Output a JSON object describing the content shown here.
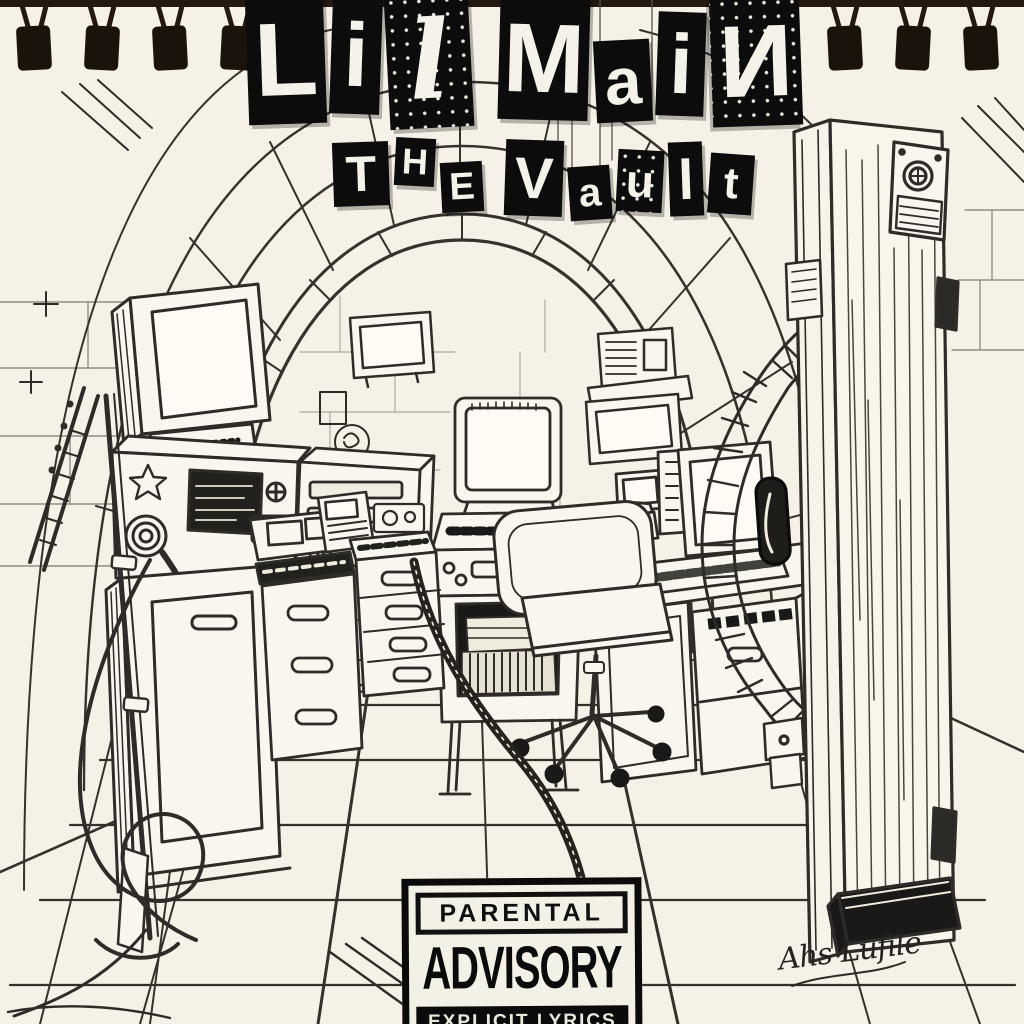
{
  "cover": {
    "title": {
      "text": "LiL MaiN",
      "words": [
        {
          "letters": [
            "L",
            "i",
            "L"
          ]
        },
        {
          "letters": [
            "M",
            "a",
            "i",
            "N"
          ]
        }
      ]
    },
    "subtitle": {
      "text": "The Vault",
      "words": [
        {
          "letters": [
            "T",
            "H",
            "E"
          ]
        },
        {
          "letters": [
            "V",
            "a",
            "u",
            "l",
            "t"
          ]
        }
      ]
    },
    "signature": "Ahs Lufile"
  },
  "advisory_label": {
    "line1": "PARENTAL",
    "line2": "ADVISORY",
    "line3": "EXPLICIT LYRICS"
  },
  "scene": {
    "medium": "black ink sketch on cream spiral-notebook paper",
    "setting": "arched bank-vault room converted into a recording studio",
    "items": [
      "spiral notebook binding",
      "stone tunnel arch ceiling",
      "wall-mounted TV",
      "CRT monitor on amplifier with star emblem",
      "audio rack unit",
      "microphone boom stand with coiled cables",
      "storage cabinet",
      "mixer console with drawers",
      "rolling drawer cart",
      "arcade-style computer kiosk",
      "shelf with speaker box",
      "desk computer with keyboard and phone",
      "office swivel chair",
      "perspective tiled floor",
      "massive open circular vault door with dial lock, hinges and handle"
    ]
  },
  "colors": {
    "paper": "#f5f1e6",
    "ink": "#2e2b28",
    "block_black": "#0c0c0c",
    "binding": "#1a120b",
    "advisory_text": "#101010"
  }
}
